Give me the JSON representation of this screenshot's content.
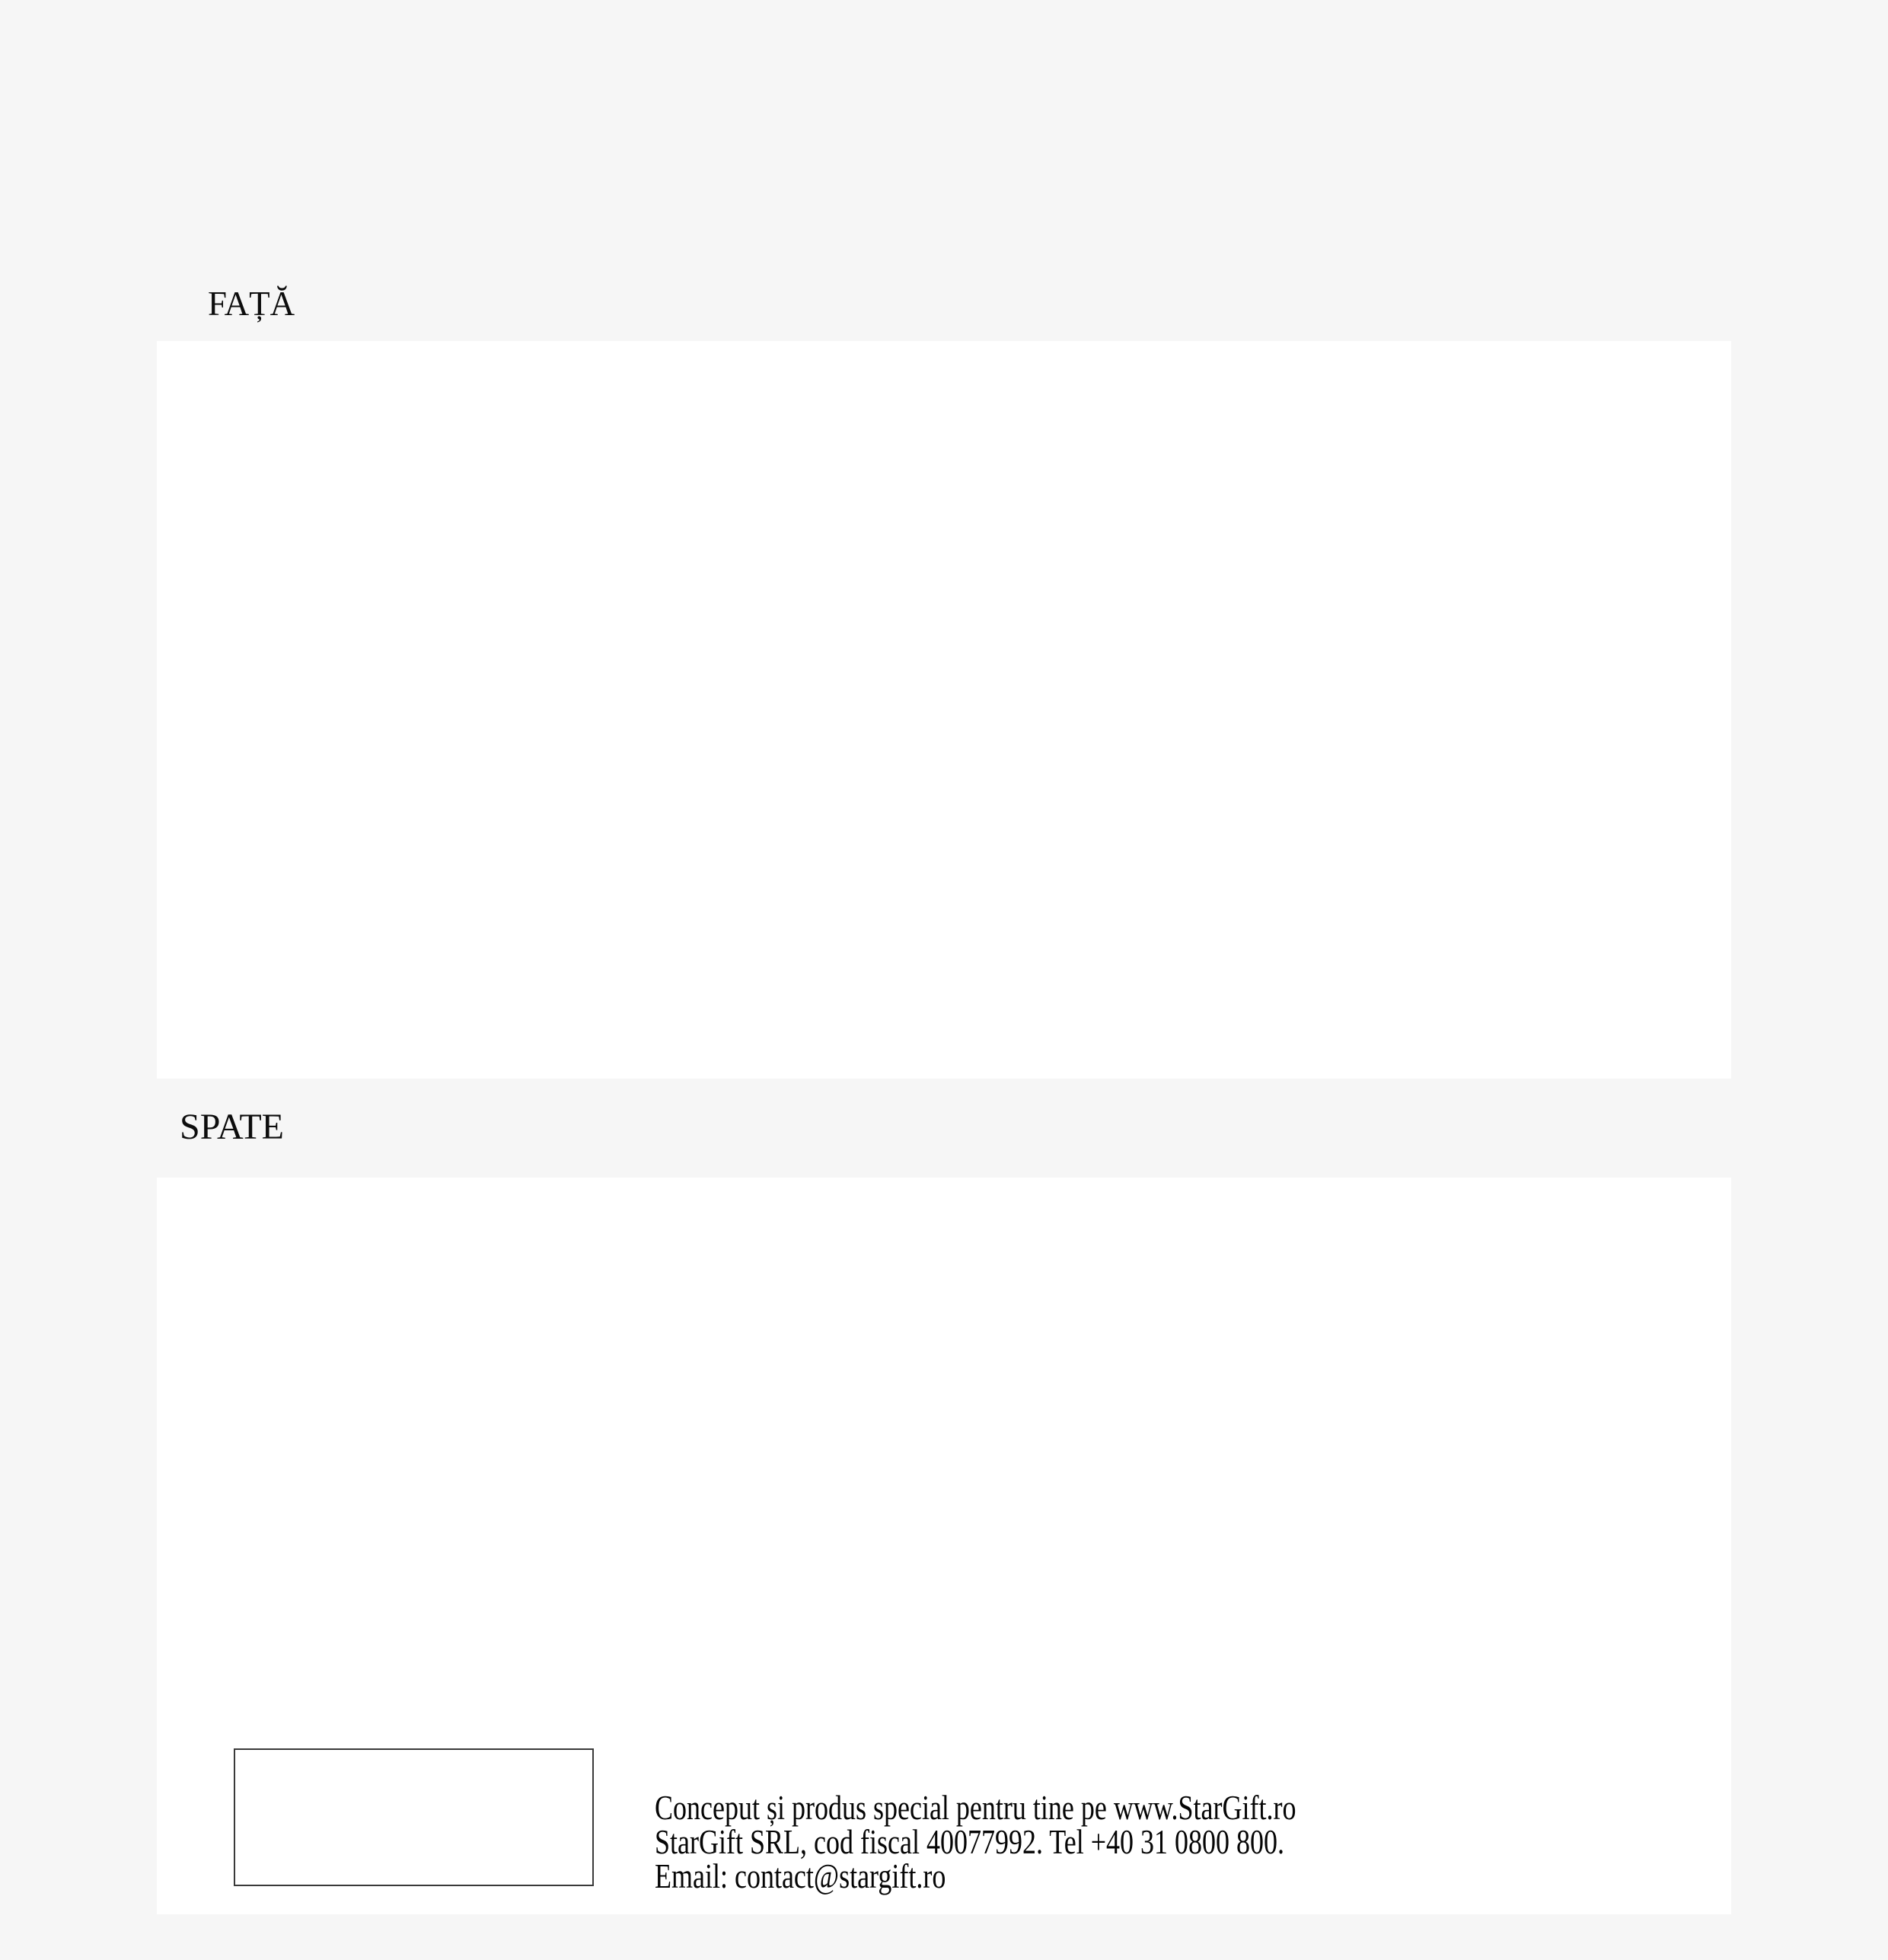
{
  "page": {
    "kind": "card-print-preview",
    "colors": {
      "background": "#f6f6f6",
      "sheet": "#ffffff",
      "text": "#0d0d0d",
      "box_border": "#3a3a3a"
    }
  },
  "sections": {
    "front": {
      "label": "FAȚĂ"
    },
    "back": {
      "label": "SPATE",
      "footer_lines": [
        "Conceput și produs special pentru tine pe www.StarGift.ro",
        "StarGift SRL, cod fiscal 40077992. Tel +40 31 0800 800.",
        "Email: contact@stargift.ro"
      ]
    }
  }
}
